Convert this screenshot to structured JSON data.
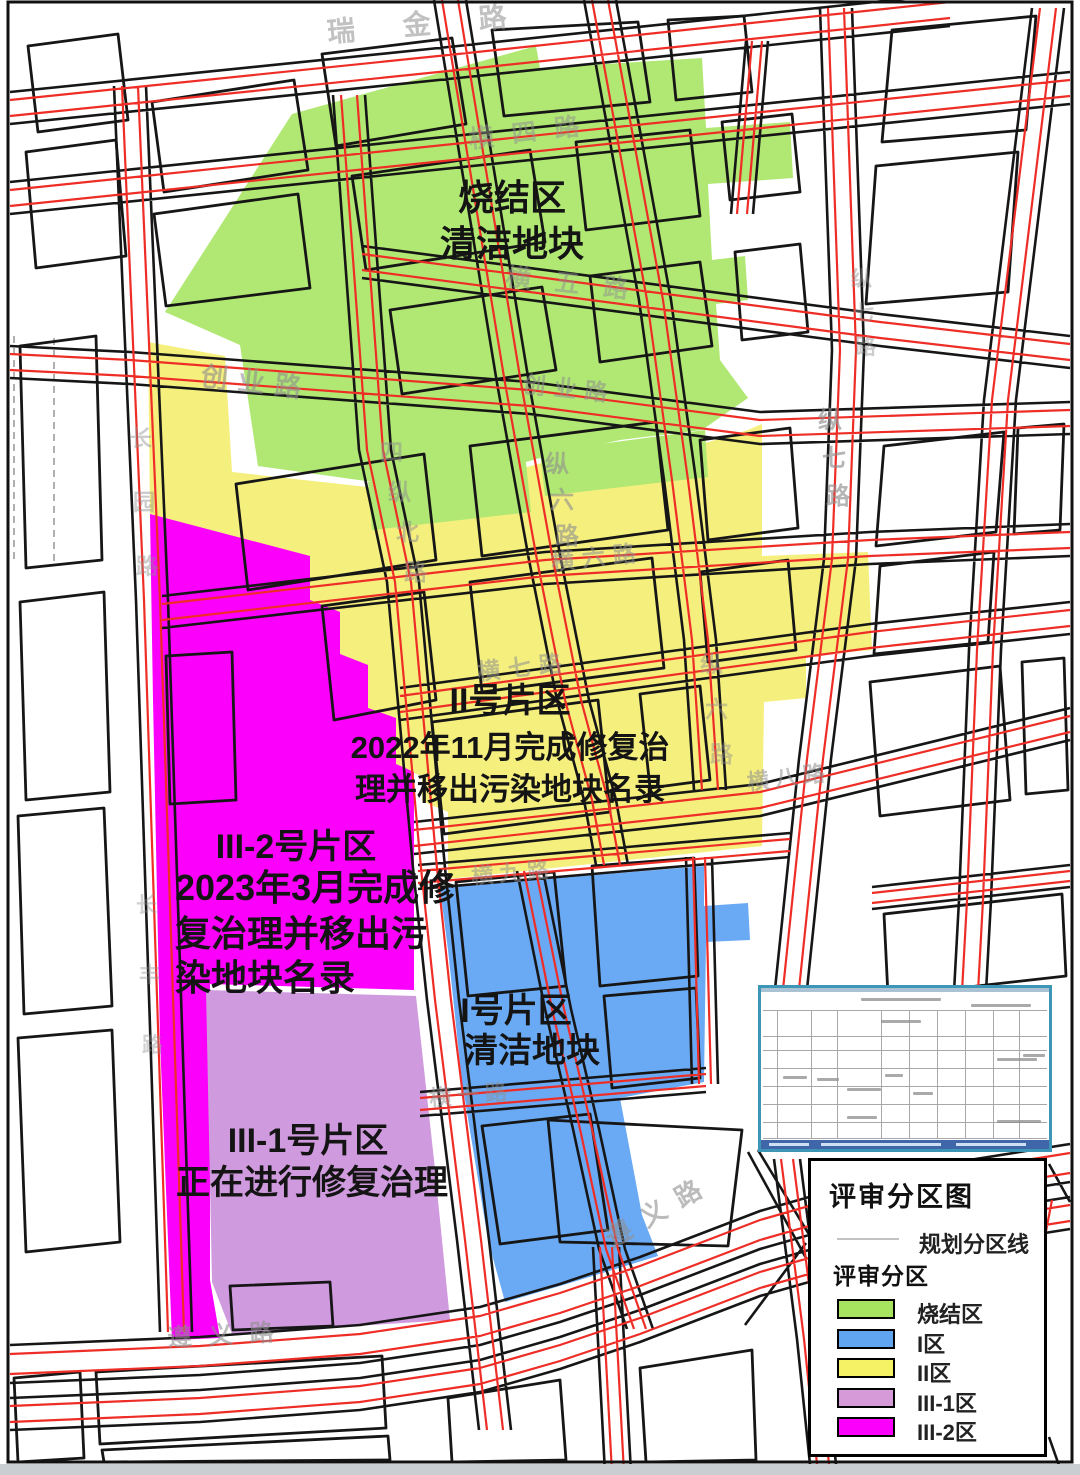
{
  "map": {
    "zone_labels": {
      "sinter": [
        "烧结区",
        "清洁地块"
      ],
      "zone2": [
        "II号片区",
        "2022年11月完成修复治",
        "理并移出污染地块名录"
      ],
      "zone3_2": [
        "III-2号片区",
        "2023年3月完成修",
        "复治理并移出污",
        "染地块名录"
      ],
      "zone1": [
        "I号片区",
        "清洁地块"
      ],
      "zone3_1": [
        "III-1号片区",
        "正在进行修复治理"
      ]
    },
    "road_labels": {
      "ruijin": "瑞金路",
      "heng4": "横四路",
      "heng5": "横五路",
      "chuangye_a": "创业路",
      "chuangye_b": "创业路",
      "zong6": "纵六路",
      "sizongbei": "四纵北路",
      "zong7_top": "纵七路",
      "zong7": "纵七路",
      "heng6": "横六路",
      "heng7": "横七路",
      "heng8": "横八路",
      "heng9": "横九路",
      "heng10": "横十路",
      "zong6b": "纵六路",
      "zunyi_diag": "遵义路",
      "zunyi_bottom": "遵义路",
      "left_a": "长园路",
      "left_b": "长丰路"
    },
    "colors": {
      "sinter": "#b0e873",
      "zone1": "#6aaaf4",
      "zone2": "#f5ef7d",
      "zone3_1": "#d09ade",
      "zone3_2": "#fb00fb",
      "road_red": "#ee2d26",
      "outline": "#161616",
      "label_gray": "#8f8f8f",
      "zone_text": "#141414"
    }
  },
  "legend": {
    "title": "评审分区图",
    "line_label": "规划分区线",
    "section_label": "评审分区",
    "items": [
      {
        "id": "sinter",
        "label": "烧结区",
        "color": "#a6e35e"
      },
      {
        "id": "zone1",
        "label": "I区",
        "color": "#5fa5f0"
      },
      {
        "id": "zone2",
        "label": "II区",
        "color": "#f5f266"
      },
      {
        "id": "zone3_1",
        "label": "III-1区",
        "color": "#d69ad8"
      },
      {
        "id": "zone3_2",
        "label": "III-2区",
        "color": "#fb00fb"
      }
    ]
  }
}
